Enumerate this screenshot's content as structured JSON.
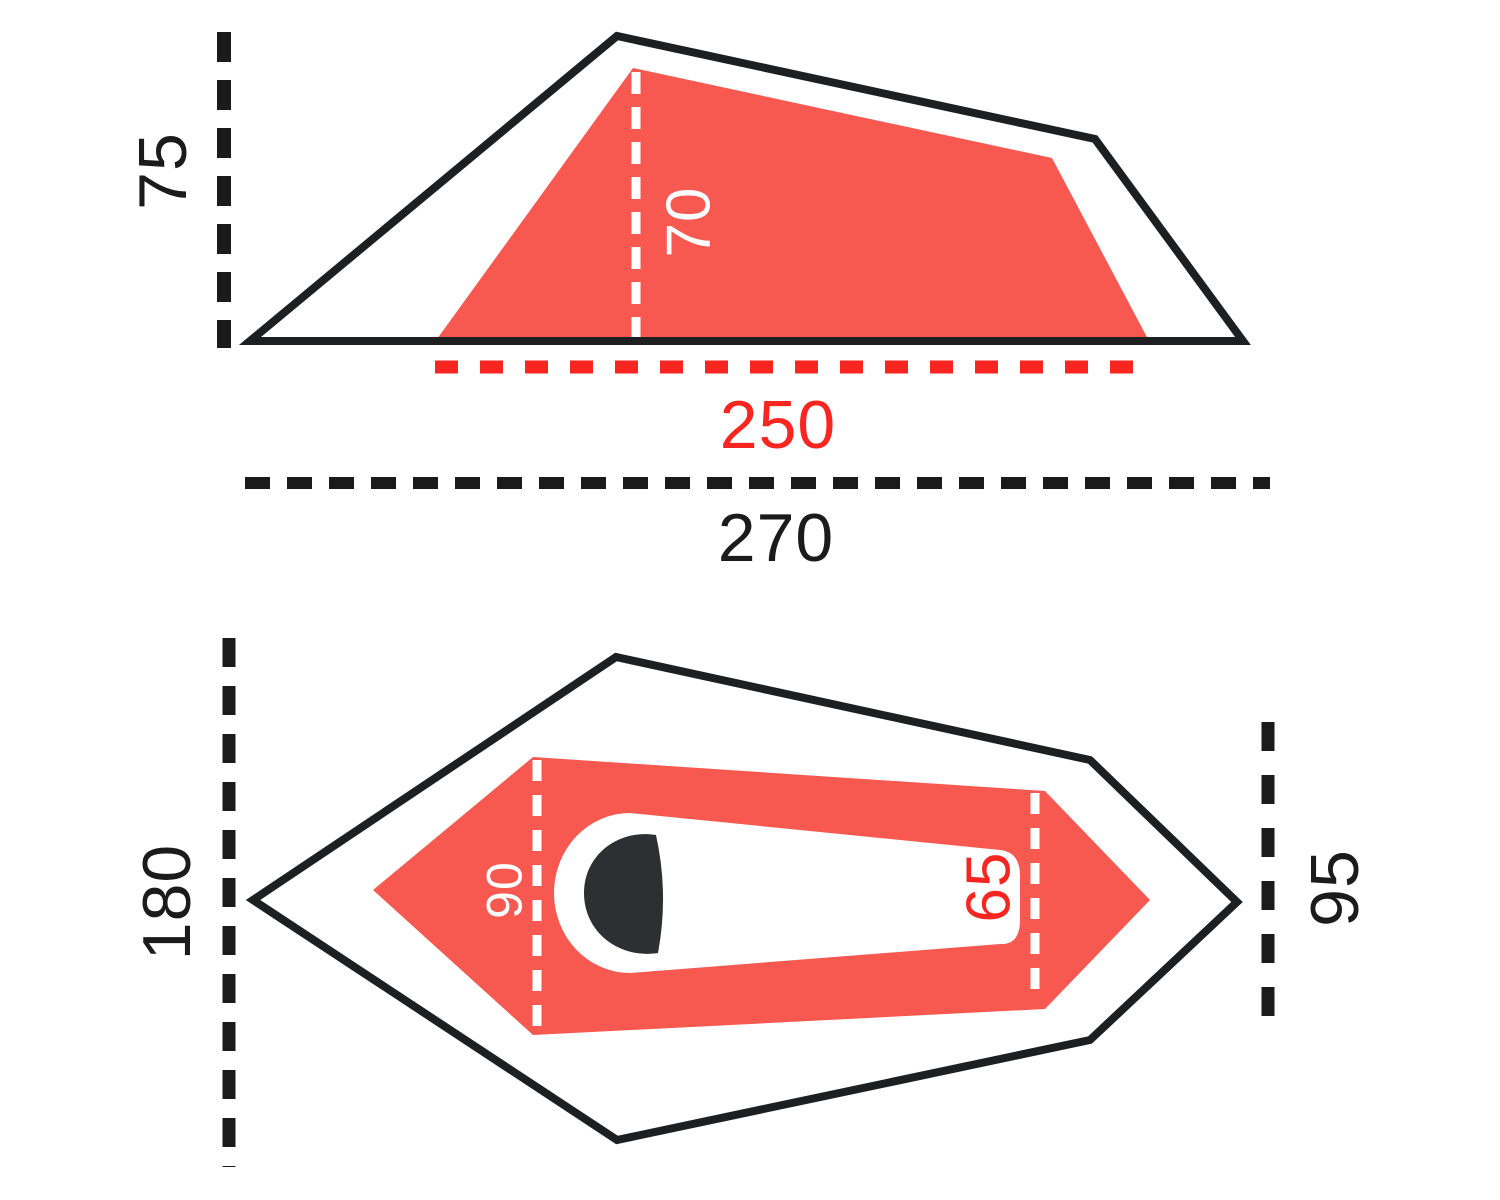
{
  "figure": {
    "type": "tent-dimensions-diagram",
    "views": {
      "side": {
        "name": "side profile view",
        "outer_height": "75",
        "inner_height": "70",
        "inner_length": "250",
        "outer_length": "270"
      },
      "plan": {
        "name": "floor plan view",
        "outer_width": "180",
        "inner_width_head": "90",
        "inner_width_foot": "65",
        "outer_foot_width": "95"
      }
    },
    "colors": {
      "outline": "#1d1f20",
      "label": "#1b1b1b",
      "tent_red": "#f75951",
      "accent_red": "#f92520",
      "white": "#ffffff",
      "sleeper": "#2d2f32"
    }
  }
}
